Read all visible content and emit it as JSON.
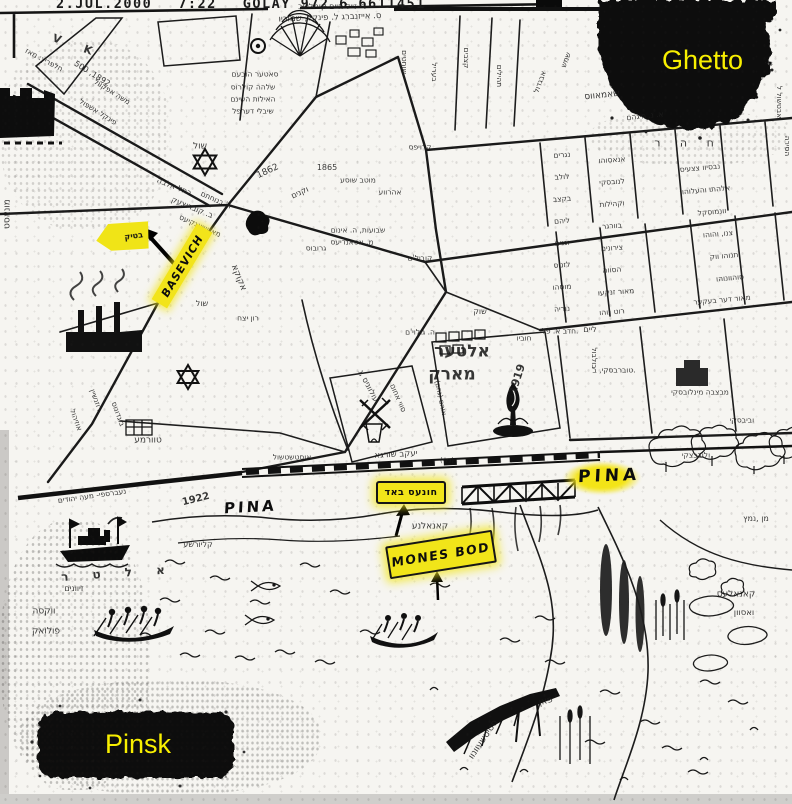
{
  "fax_header": {
    "date": "2.JUL.2000",
    "time": "7:22",
    "station": "GOLAY 972 6 6611451"
  },
  "labels": {
    "ghetto": "Ghetto",
    "pinsk": "Pinsk",
    "pina_river_left": "PINA",
    "pina_river_right": "PINA",
    "mones_bod": "MONES BOD",
    "basevich": "BASEVICH",
    "hones_bod_hebrew": "חונעס באד",
    "bank_highlight_hebrew": "בטיק"
  },
  "colors": {
    "highlight_yellow": "#f2e51c",
    "label_yellow": "#f8ef00",
    "ink": "#1a1a1a",
    "paper": "#f6f5f1"
  },
  "map_labels": [
    {
      "t": "ר' זייל חיים קומליווב",
      "x": 332,
      "y": 7,
      "r": 0,
      "s": 8
    },
    {
      "t": "ס. אייזנברג ל. פינקל, שמוריו",
      "x": 330,
      "y": 18,
      "r": -2,
      "s": 8.5
    },
    {
      "t": "V",
      "x": 57,
      "y": 39,
      "r": 20,
      "s": 11,
      "w": 1
    },
    {
      "t": "K",
      "x": 88,
      "y": 50,
      "r": 20,
      "s": 11,
      "w": 1
    },
    {
      "t": "חלפריץ: מאז",
      "x": 44,
      "y": 60,
      "r": 28,
      "s": 7.5
    },
    {
      "t": "500 ,1892",
      "x": 92,
      "y": 74,
      "r": 32,
      "s": 8
    },
    {
      "t": "משה אפקוול",
      "x": 112,
      "y": 92,
      "r": 32,
      "s": 7.5
    },
    {
      "t": "פינקל אשפול",
      "x": 98,
      "y": 112,
      "r": 32,
      "s": 7.5
    },
    {
      "t": "סאטער הובעם",
      "x": 255,
      "y": 74,
      "r": 0,
      "s": 7.5
    },
    {
      "t": "שלהה קולרוס",
      "x": 253,
      "y": 87,
      "r": 0,
      "s": 7.5
    },
    {
      "t": "האילות השינם",
      "x": 253,
      "y": 99,
      "r": 0,
      "s": 7.5
    },
    {
      "t": "שיבלי דערפל",
      "x": 253,
      "y": 111,
      "r": 0,
      "s": 7.5
    },
    {
      "t": "שוחטים",
      "x": 404,
      "y": 62,
      "r": 90,
      "s": 7.5
    },
    {
      "t": "בעריל",
      "x": 434,
      "y": 72,
      "r": 90,
      "s": 7.5
    },
    {
      "t": "קצבים",
      "x": 466,
      "y": 58,
      "r": 90,
      "s": 7.5
    },
    {
      "t": "תהילים",
      "x": 499,
      "y": 76,
      "r": 90,
      "s": 7.5
    },
    {
      "t": "אבגדול",
      "x": 540,
      "y": 82,
      "r": -70,
      "s": 7.5
    },
    {
      "t": "שמש",
      "x": 566,
      "y": 60,
      "r": -70,
      "s": 7.5
    },
    {
      "t": "שול",
      "x": 200,
      "y": 147,
      "r": 0,
      "s": 9
    },
    {
      "t": "רחל אלבה",
      "x": 174,
      "y": 187,
      "r": 22,
      "s": 8
    },
    {
      "t": "ב. קוברוצעק",
      "x": 192,
      "y": 208,
      "r": 22,
      "s": 8
    },
    {
      "t": "1862",
      "x": 268,
      "y": 172,
      "r": -25,
      "s": 9
    },
    {
      "t": "וקנים",
      "x": 300,
      "y": 193,
      "r": -25,
      "s": 8
    },
    {
      "t": "1865",
      "x": 327,
      "y": 168,
      "r": 0,
      "s": 8
    },
    {
      "t": "מוטב שוסע",
      "x": 358,
      "y": 180,
      "r": 0,
      "s": 7.5
    },
    {
      "t": "אהרווע",
      "x": 390,
      "y": 192,
      "r": 0,
      "s": 7.5
    },
    {
      "t": "קרויפס",
      "x": 420,
      "y": 147,
      "r": 0,
      "s": 7.5
    },
    {
      "t": "ר' בנוחתם",
      "x": 216,
      "y": 200,
      "r": 24,
      "s": 7.5
    },
    {
      "t": "מאטשאנקיעס",
      "x": 200,
      "y": 226,
      "r": 24,
      "s": 7.5
    },
    {
      "t": "שבועות, ה. אינום",
      "x": 358,
      "y": 230,
      "r": 0,
      "s": 7.5
    },
    {
      "t": "מ. אסאנדיעס",
      "x": 352,
      "y": 242,
      "r": 0,
      "s": 7.5
    },
    {
      "t": "גרובוס",
      "x": 316,
      "y": 248,
      "r": 0,
      "s": 7.5
    },
    {
      "t": "קוביל'ם",
      "x": 420,
      "y": 258,
      "r": 0,
      "s": 7.5
    },
    {
      "t": "אקוקא",
      "x": 238,
      "y": 278,
      "r": 68,
      "s": 9
    },
    {
      "t": "שול",
      "x": 202,
      "y": 304,
      "r": 0,
      "s": 8
    },
    {
      "t": "רון יצח",
      "x": 248,
      "y": 318,
      "r": 0,
      "s": 7.5
    },
    {
      "t": "ה. גולוי'ם",
      "x": 420,
      "y": 332,
      "r": 0,
      "s": 7.5
    },
    {
      "t": "שאמאווס",
      "x": 602,
      "y": 96,
      "r": -6,
      "s": 9
    },
    {
      "t": "א. נ. חיגהם",
      "x": 645,
      "y": 116,
      "r": -6,
      "s": 7.5
    },
    {
      "t": "ח ה ר",
      "x": 688,
      "y": 143,
      "r": 0,
      "s": 11,
      "ls": 8
    },
    {
      "t": "אבטשול ל",
      "x": 779,
      "y": 102,
      "r": 90,
      "s": 7.5
    },
    {
      "t": "הסירה",
      "x": 787,
      "y": 146,
      "r": 90,
      "s": 7.5
    },
    {
      "t": "נגרים",
      "x": 562,
      "y": 155,
      "r": -4,
      "s": 7.5
    },
    {
      "t": "לולב",
      "x": 562,
      "y": 177,
      "r": -4,
      "s": 7.5
    },
    {
      "t": "בקצב",
      "x": 562,
      "y": 199,
      "r": -4,
      "s": 7.5
    },
    {
      "t": "ליהם",
      "x": 562,
      "y": 221,
      "r": -4,
      "s": 7.5
    },
    {
      "t": "וגנים",
      "x": 562,
      "y": 243,
      "r": -4,
      "s": 7.5
    },
    {
      "t": "לזנוס",
      "x": 562,
      "y": 265,
      "r": -4,
      "s": 7.5
    },
    {
      "t": "מוסהו",
      "x": 562,
      "y": 287,
      "r": -4,
      "s": 7.5
    },
    {
      "t": "נוריה",
      "x": 562,
      "y": 309,
      "r": -4,
      "s": 7.5
    },
    {
      "t": "אנאסוהו",
      "x": 612,
      "y": 160,
      "r": -4,
      "s": 7.5
    },
    {
      "t": "לנובסקי",
      "x": 612,
      "y": 182,
      "r": -4,
      "s": 7.5
    },
    {
      "t": "וקהילות",
      "x": 612,
      "y": 204,
      "r": -4,
      "s": 7.5
    },
    {
      "t": "בוורגר",
      "x": 612,
      "y": 226,
      "r": -4,
      "s": 7.5
    },
    {
      "t": "צירונים",
      "x": 612,
      "y": 248,
      "r": -4,
      "s": 7.5
    },
    {
      "t": "הסווה",
      "x": 612,
      "y": 270,
      "r": -4,
      "s": 7.5
    },
    {
      "t": "מאור זנקעו",
      "x": 616,
      "y": 292,
      "r": -4,
      "s": 7.5
    },
    {
      "t": "רוט נוהו",
      "x": 612,
      "y": 312,
      "r": -4,
      "s": 7.5
    },
    {
      "t": "נבסיוו צצעיס",
      "x": 700,
      "y": 168,
      "r": -5,
      "s": 7.5
    },
    {
      "t": "אלהתו והעלוהו",
      "x": 706,
      "y": 190,
      "r": -5,
      "s": 7.5
    },
    {
      "t": "וונמוסקל",
      "x": 712,
      "y": 212,
      "r": -5,
      "s": 7.5
    },
    {
      "t": "צנו, והוהו",
      "x": 718,
      "y": 234,
      "r": -5,
      "s": 7.5
    },
    {
      "t": "תנוהו ווק",
      "x": 724,
      "y": 256,
      "r": -5,
      "s": 7.5
    },
    {
      "t": "סוהוונוהו",
      "x": 730,
      "y": 278,
      "r": -5,
      "s": 7.5
    },
    {
      "t": "מאור דער בעקער",
      "x": 722,
      "y": 300,
      "r": -5,
      "s": 7.5
    },
    {
      "t": "חדב א. פל.",
      "x": 560,
      "y": 331,
      "r": 0,
      "s": 7.5
    },
    {
      "t": "חוביו",
      "x": 524,
      "y": 338,
      "r": 0,
      "s": 7.5
    },
    {
      "t": "ליים",
      "x": 590,
      "y": 330,
      "r": 0,
      "s": 8
    },
    {
      "t": "בולבול",
      "x": 594,
      "y": 358,
      "r": 90,
      "s": 7.5
    },
    {
      "t": "אלטער",
      "x": 462,
      "y": 352,
      "r": 0,
      "s": 17,
      "w": 1
    },
    {
      "t": "מארק",
      "x": 452,
      "y": 375,
      "r": 0,
      "s": 17,
      "w": 1
    },
    {
      "t": "1919",
      "x": 517,
      "y": 379,
      "r": -72,
      "s": 11,
      "w": 1
    },
    {
      "t": "מבצבה מינלובסקי",
      "x": 700,
      "y": 392,
      "r": 0,
      "s": 7.5
    },
    {
      "t": "טוברבסקי, ב.",
      "x": 614,
      "y": 370,
      "r": 0,
      "s": 7.5
    },
    {
      "t": "ולודבצקי",
      "x": 696,
      "y": 455,
      "r": 0,
      "s": 7.5
    },
    {
      "t": "וביבסקי",
      "x": 742,
      "y": 420,
      "r": 0,
      "s": 7.5
    },
    {
      "t": "עולווניס ,ג",
      "x": 368,
      "y": 386,
      "r": 62,
      "s": 8
    },
    {
      "t": "סווי אחום",
      "x": 398,
      "y": 398,
      "r": 66,
      "s": 7.5
    },
    {
      "t": "אוהם (גהם)",
      "x": 440,
      "y": 398,
      "r": 78,
      "s": 7
    },
    {
      "t": "יעקב שורגא",
      "x": 396,
      "y": 455,
      "r": -3,
      "s": 8.5
    },
    {
      "t": "אוסטשטשול",
      "x": 292,
      "y": 457,
      "r": 0,
      "s": 7.5
    },
    {
      "t": "טוורמע",
      "x": 148,
      "y": 441,
      "r": 0,
      "s": 9
    },
    {
      "t": "רוזנשיין",
      "x": 96,
      "y": 400,
      "r": 70,
      "s": 7.5
    },
    {
      "t": "בוגדונוס",
      "x": 118,
      "y": 414,
      "r": 70,
      "s": 7.5
    },
    {
      "t": "אוזיהול",
      "x": 76,
      "y": 420,
      "r": 70,
      "s": 7.5
    },
    {
      "t": "נעברספי- מעה יהודים",
      "x": 92,
      "y": 496,
      "r": -8,
      "s": 7.5
    },
    {
      "t": "1922",
      "x": 196,
      "y": 500,
      "r": -14,
      "s": 10,
      "w": 1
    },
    {
      "t": "קליורשע",
      "x": 198,
      "y": 545,
      "r": 0,
      "s": 8
    },
    {
      "t": "קאנאלנע",
      "x": 430,
      "y": 527,
      "r": 0,
      "s": 9
    },
    {
      "t": "(גלי)",
      "x": 447,
      "y": 461,
      "r": 0,
      "s": 7
    },
    {
      "t": "א ל ט ר",
      "x": 118,
      "y": 573,
      "r": -4,
      "s": 12,
      "ls": 10,
      "w": 1
    },
    {
      "t": "זיוונים",
      "x": 74,
      "y": 589,
      "r": 0,
      "s": 8
    },
    {
      "t": "ווקסה",
      "x": 44,
      "y": 612,
      "r": 0,
      "s": 9
    },
    {
      "t": "פולואק",
      "x": 46,
      "y": 632,
      "r": 0,
      "s": 9
    },
    {
      "t": "מן ,נמץ",
      "x": 756,
      "y": 519,
      "r": 0,
      "s": 8
    },
    {
      "t": "קאנאלעס",
      "x": 736,
      "y": 595,
      "r": 0,
      "s": 9
    },
    {
      "t": "ואסוון",
      "x": 744,
      "y": 613,
      "r": 0,
      "s": 8.5
    },
    {
      "t": "סטיטשעוונוו",
      "x": 484,
      "y": 740,
      "r": -56,
      "s": 9
    },
    {
      "t": "פאן",
      "x": 546,
      "y": 702,
      "r": -15,
      "s": 9
    },
    {
      "t": "מונאסט",
      "x": 8,
      "y": 214,
      "r": -90,
      "s": 9
    },
    {
      "t": "שוק",
      "x": 480,
      "y": 312,
      "r": 0,
      "s": 8
    }
  ]
}
